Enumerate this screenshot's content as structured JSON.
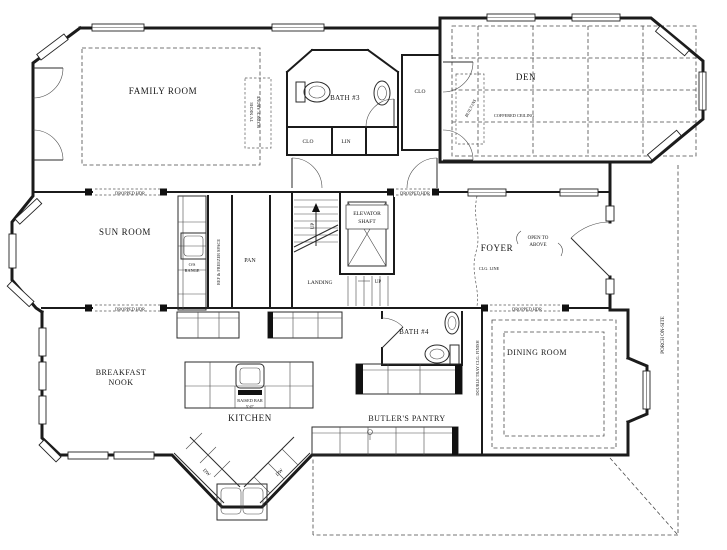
{
  "plan": {
    "colors": {
      "ink": "#1c1c1c",
      "background": "#ffffff"
    },
    "labels": {
      "family_room": "FAMILY ROOM",
      "sun_room": "SUN ROOM",
      "den": "DEN",
      "coffered_ceiling": "COFFERED CEILING",
      "bath3": "BATH #3",
      "clo": "CLO",
      "lin": "LIN",
      "foyer": "FOYER",
      "open_to": "OPEN TO",
      "above": "ABOVE",
      "clg_line": "CLG. LINE",
      "elevator": "ELEVATOR",
      "shaft": "SHAFT",
      "landing": "LANDING",
      "up": "UP",
      "pan": "PAN",
      "ref_freezer": "REF & FREEZER SPACE",
      "os_range_1": "O/S",
      "os_range_2": "RANGE",
      "dropped_hdr": "DROPPED HDR",
      "breakfast_1": "BREAKFAST",
      "breakfast_2": "NOOK",
      "kitchen": "KITCHEN",
      "raised_bar": "RAISED BAR",
      "raised_bar_dim": "5'-0\"",
      "dw": "DW",
      "bath4": "BATH #4",
      "butlers_pantry": "BUTLER'S PANTRY",
      "dining_room": "DINING ROOM",
      "double_tray": "DOUBLE TRAY CLG. FINISH",
      "porch": "PORCH ON-SITE",
      "tv_niche_1": "TV NICHE",
      "tv_niche_2": "SCONCE ABOVE",
      "built_ins": "BUILT-INS"
    }
  }
}
